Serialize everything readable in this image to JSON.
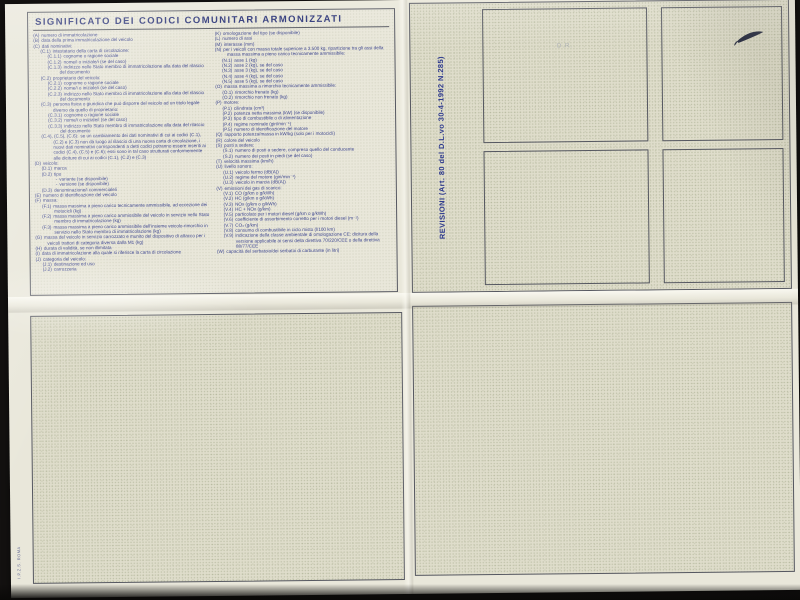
{
  "sheet": {
    "title": "SIGNIFICATO DEI CODICI COMUNITARI ARMONIZZATI",
    "revisioni_label": "REVISIONI (Art. 80 del D.L.vo 30-4-1992 N.285)",
    "faint_mark": "D.R.",
    "print_code": "I.P.Z.S. ROMA",
    "colors": {
      "ink_blue": "#3d4690",
      "title_blue": "#2c3578",
      "paper": "#e9e7da",
      "paper_texture": "#dfddcb",
      "border": "#565861",
      "background": "#211e1b"
    },
    "legend_left": [
      {
        "code": "(A)",
        "text": "numero di immatricolazione",
        "indent": 0
      },
      {
        "code": "(B)",
        "text": "data della prima immatricolazione del veicolo",
        "indent": 0
      },
      {
        "code": "(C)",
        "text": "dati nominativi:",
        "indent": 0
      },
      {
        "code": "(C.1)",
        "text": "intestatario della carta di circolazione:",
        "indent": 1
      },
      {
        "code": "(C.1.1)",
        "text": "cognome o ragione sociale",
        "indent": 2
      },
      {
        "code": "(C.1.2)",
        "text": "nome/i o iniziale/i (se del caso)",
        "indent": 2
      },
      {
        "code": "(C.1.3)",
        "text": "indirizzo nello Stato membro di immatricolazione alla data del rilascio del documento",
        "indent": 2
      },
      {
        "code": "(C.2)",
        "text": "proprietario del veicolo:",
        "indent": 1
      },
      {
        "code": "(C.2.1)",
        "text": "cognome o ragione sociale",
        "indent": 2
      },
      {
        "code": "(C.2.2)",
        "text": "nome/i o iniziale/i (se del caso)",
        "indent": 2
      },
      {
        "code": "(C.2.3)",
        "text": "indirizzo nello Stato membro di immatricolazione alla data del rilascio del documento",
        "indent": 2
      },
      {
        "code": "(C.3)",
        "text": "persona fisica o giuridica che può disporre del veicolo ad un titolo legale diverso da quello di proprietario:",
        "indent": 1
      },
      {
        "code": "(C.3.1)",
        "text": "cognome o ragione sociale",
        "indent": 2
      },
      {
        "code": "(C.3.2)",
        "text": "nome/i o iniziale/i (se del caso)",
        "indent": 2
      },
      {
        "code": "(C.3.3)",
        "text": "indirizzo nello Stato membro di immatricolazione alla data del rilascio del documento",
        "indent": 2
      },
      {
        "code": "(C.4), (C.5), (C.6):",
        "text": "se un cambiamento dei dati nominativi di cui ai codici (C.1), (C.2) e (C.3) non dà luogo al rilascio di una nuova carta di circolazione, i nuovi dati nominativi corrispondenti a detti codici potranno essere inseriti ai codici (C.4), (C.5) e (C.6); essi sono in tal caso strutturati conformemente alle diciture di cui ai codici (C.1), (C.2) e (C.3)",
        "indent": 1
      },
      {
        "code": "(D)",
        "text": "veicolo:",
        "indent": 0
      },
      {
        "code": "(D.1)",
        "text": "marca",
        "indent": 1
      },
      {
        "code": "(D.2)",
        "text": "tipo",
        "indent": 1
      },
      {
        "code": "-",
        "text": "variante (se disponibile)",
        "indent": 3
      },
      {
        "code": "-",
        "text": "versione (se disponibile)",
        "indent": 3
      },
      {
        "code": "(D.3)",
        "text": "denominazione/i commerciale/i",
        "indent": 1
      },
      {
        "code": "(E)",
        "text": "numero di identificazione del veicolo",
        "indent": 0
      },
      {
        "code": "(F)",
        "text": "massa:",
        "indent": 0
      },
      {
        "code": "(F.1)",
        "text": "massa massima a pieno carico tecnicamente ammissibile, ad eccezione dei motocicli (kg)",
        "indent": 1
      },
      {
        "code": "(F.2)",
        "text": "massa massima a pieno carico ammissibile del veicolo in servizio nello Stato membro di immatricolazione (kg)",
        "indent": 1
      },
      {
        "code": "(F.3)",
        "text": "massa massima a pieno carico ammissibile dell'insieme veicolo-rimorchio in servizio nello Stato membro di immatricolazione (kg)",
        "indent": 1
      },
      {
        "code": "(G)",
        "text": "massa del veicolo in servizio carrozzato e munito del dispositivo di attacco per i veicoli trattori di categoria diversa dalla M1 (kg)",
        "indent": 0
      },
      {
        "code": "(H)",
        "text": "durata di validità, se non illimitata",
        "indent": 0
      },
      {
        "code": "(I)",
        "text": "data di immatricolazione alla quale si riferisce la carta di circolazione",
        "indent": 0
      },
      {
        "code": "(J)",
        "text": "categoria del veicolo:",
        "indent": 0
      },
      {
        "code": "(J.1)",
        "text": "destinazione ed uso",
        "indent": 1
      },
      {
        "code": "(J.2)",
        "text": "carrozzeria",
        "indent": 1
      }
    ],
    "legend_right": [
      {
        "code": "(K)",
        "text": "omologazione del tipo (se disponibile)",
        "indent": 0
      },
      {
        "code": "(L)",
        "text": "numero di assi",
        "indent": 0
      },
      {
        "code": "(M)",
        "text": "interasse (mm)",
        "indent": 0
      },
      {
        "code": "(N)",
        "text": "per i veicoli con massa totale superiore a 3.500 kg, ripartizione tra gli assi della massa massima a pieno carico tecnicamente ammissibile:",
        "indent": 0
      },
      {
        "code": "(N.1)",
        "text": "asse 1 (kg)",
        "indent": 1
      },
      {
        "code": "(N.2)",
        "text": "asse 2 (kg), se del caso",
        "indent": 1
      },
      {
        "code": "(N.3)",
        "text": "asse 3 (kg), se del caso",
        "indent": 1
      },
      {
        "code": "(N.4)",
        "text": "asse 4 (kg), se del caso",
        "indent": 1
      },
      {
        "code": "(N.5)",
        "text": "asse 5 (kg), se del caso",
        "indent": 1
      },
      {
        "code": "(O)",
        "text": "massa massima a rimorchio tecnicamente ammissibile:",
        "indent": 0
      },
      {
        "code": "(O.1)",
        "text": "rimorchio frenato (kg)",
        "indent": 1
      },
      {
        "code": "(O.2)",
        "text": "rimorchio non frenato (kg)",
        "indent": 1
      },
      {
        "code": "(P)",
        "text": "motore:",
        "indent": 0
      },
      {
        "code": "(P.1)",
        "text": "cilindrata (cm³)",
        "indent": 1
      },
      {
        "code": "(P.2)",
        "text": "potenza netta massima (kW) (se disponibile)",
        "indent": 1
      },
      {
        "code": "(P.3)",
        "text": "tipo di combustibile o di alimentazione",
        "indent": 1
      },
      {
        "code": "(P.4)",
        "text": "regime nominale (giri/min⁻¹)",
        "indent": 1
      },
      {
        "code": "(P.5)",
        "text": "numero di identificazione del motore",
        "indent": 1
      },
      {
        "code": "(Q)",
        "text": "rapporto potenza/massa in kW/kg (solo per i motocicli)",
        "indent": 0
      },
      {
        "code": "(R)",
        "text": "colore del veicolo",
        "indent": 0
      },
      {
        "code": "(S)",
        "text": "posti a sedere:",
        "indent": 0
      },
      {
        "code": "(S.1)",
        "text": "numero di posti a sedere, compreso quello del conducente",
        "indent": 1
      },
      {
        "code": "(S.2)",
        "text": "numero dei posti in piedi (se del caso)",
        "indent": 1
      },
      {
        "code": "(T)",
        "text": "velocità massima (km/h)",
        "indent": 0
      },
      {
        "code": "(U)",
        "text": "livello sonoro:",
        "indent": 0
      },
      {
        "code": "(U.1)",
        "text": "veicolo fermo (dB(A))",
        "indent": 1
      },
      {
        "code": "(U.2)",
        "text": "regime del motore (giri/min⁻¹)",
        "indent": 1
      },
      {
        "code": "(U.3)",
        "text": "veicolo in marcia (dB(A))",
        "indent": 1
      },
      {
        "code": "(V)",
        "text": "emissioni dei gas di scarico:",
        "indent": 0
      },
      {
        "code": "(V.1)",
        "text": "CO (g/km o g/kWh)",
        "indent": 1
      },
      {
        "code": "(V.2)",
        "text": "HC (g/km o g/kWh)",
        "indent": 1
      },
      {
        "code": "(V.3)",
        "text": "NOx (g/km o g/kWh)",
        "indent": 1
      },
      {
        "code": "(V.4)",
        "text": "HC + NOx (g/km)",
        "indent": 1
      },
      {
        "code": "(V.5)",
        "text": "particolato per i motori diesel (g/km o g/kWh)",
        "indent": 1
      },
      {
        "code": "(V.6)",
        "text": "coefficiente di assorbimento corretto per i motori diesel (m⁻¹)",
        "indent": 1
      },
      {
        "code": "(V.7)",
        "text": "CO₂ (g/km)",
        "indent": 1
      },
      {
        "code": "(V.8)",
        "text": "consumo di combustibile in ciclo misto (l/100 km)",
        "indent": 1
      },
      {
        "code": "(V.9)",
        "text": "indicazione della classe ambientale di omologazione CE: dicitura della versione applicabile ai sensi della direttiva 70/220/CEE o della direttiva 88/77/CEE",
        "indent": 1
      },
      {
        "code": "(W)",
        "text": "capacità del serbatoio/dei serbatoi di carburante (in litri)",
        "indent": 0
      }
    ]
  }
}
